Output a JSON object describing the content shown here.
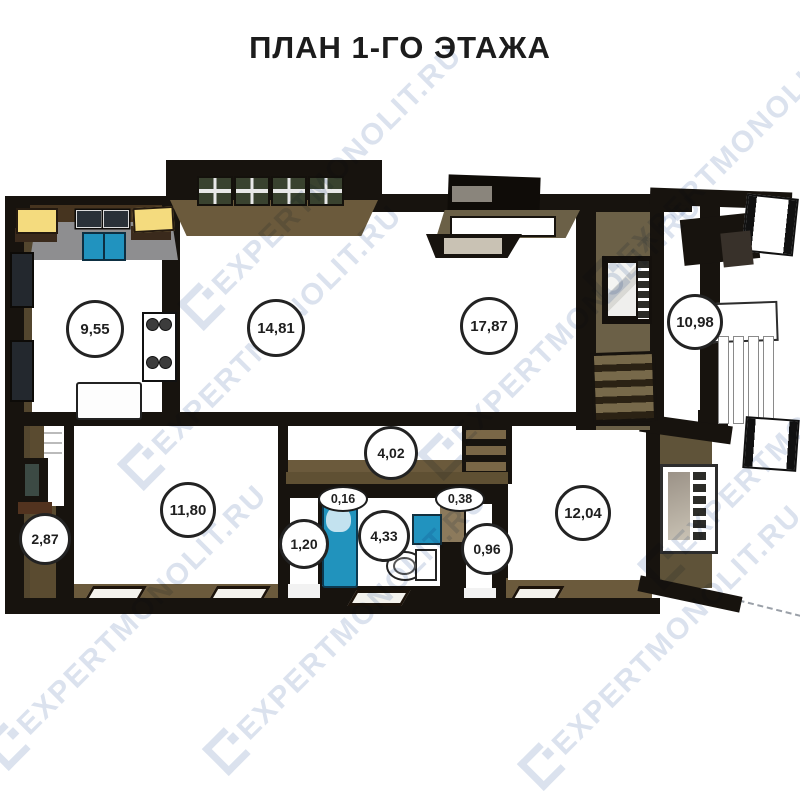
{
  "title": "ПЛАН 1-ГО ЭТАЖА",
  "watermark": {
    "text": "EXPERTMONOLIT.RU"
  },
  "palette": {
    "wall_dark": "#17130e",
    "floor_brown": "#6b5a3c",
    "wall_face_olive": "#6b6047",
    "counter_gray": "#8e8e90",
    "accent_blue": "#2193bf",
    "accent_yellow": "#f4db7e",
    "room_white": "#ffffff",
    "watermark_gray": "#dbe2ee",
    "label_border": "#232323"
  },
  "rooms": [
    {
      "area": "9,55"
    },
    {
      "area": "14,81"
    },
    {
      "area": "17,87"
    },
    {
      "area": "10,98"
    },
    {
      "area": "11,80"
    },
    {
      "area": "2,87"
    },
    {
      "area": "4,02"
    },
    {
      "area": "0,16"
    },
    {
      "area": "0,38"
    },
    {
      "area": "1,20"
    },
    {
      "area": "4,33"
    },
    {
      "area": "0,96"
    },
    {
      "area": "12,04"
    }
  ]
}
